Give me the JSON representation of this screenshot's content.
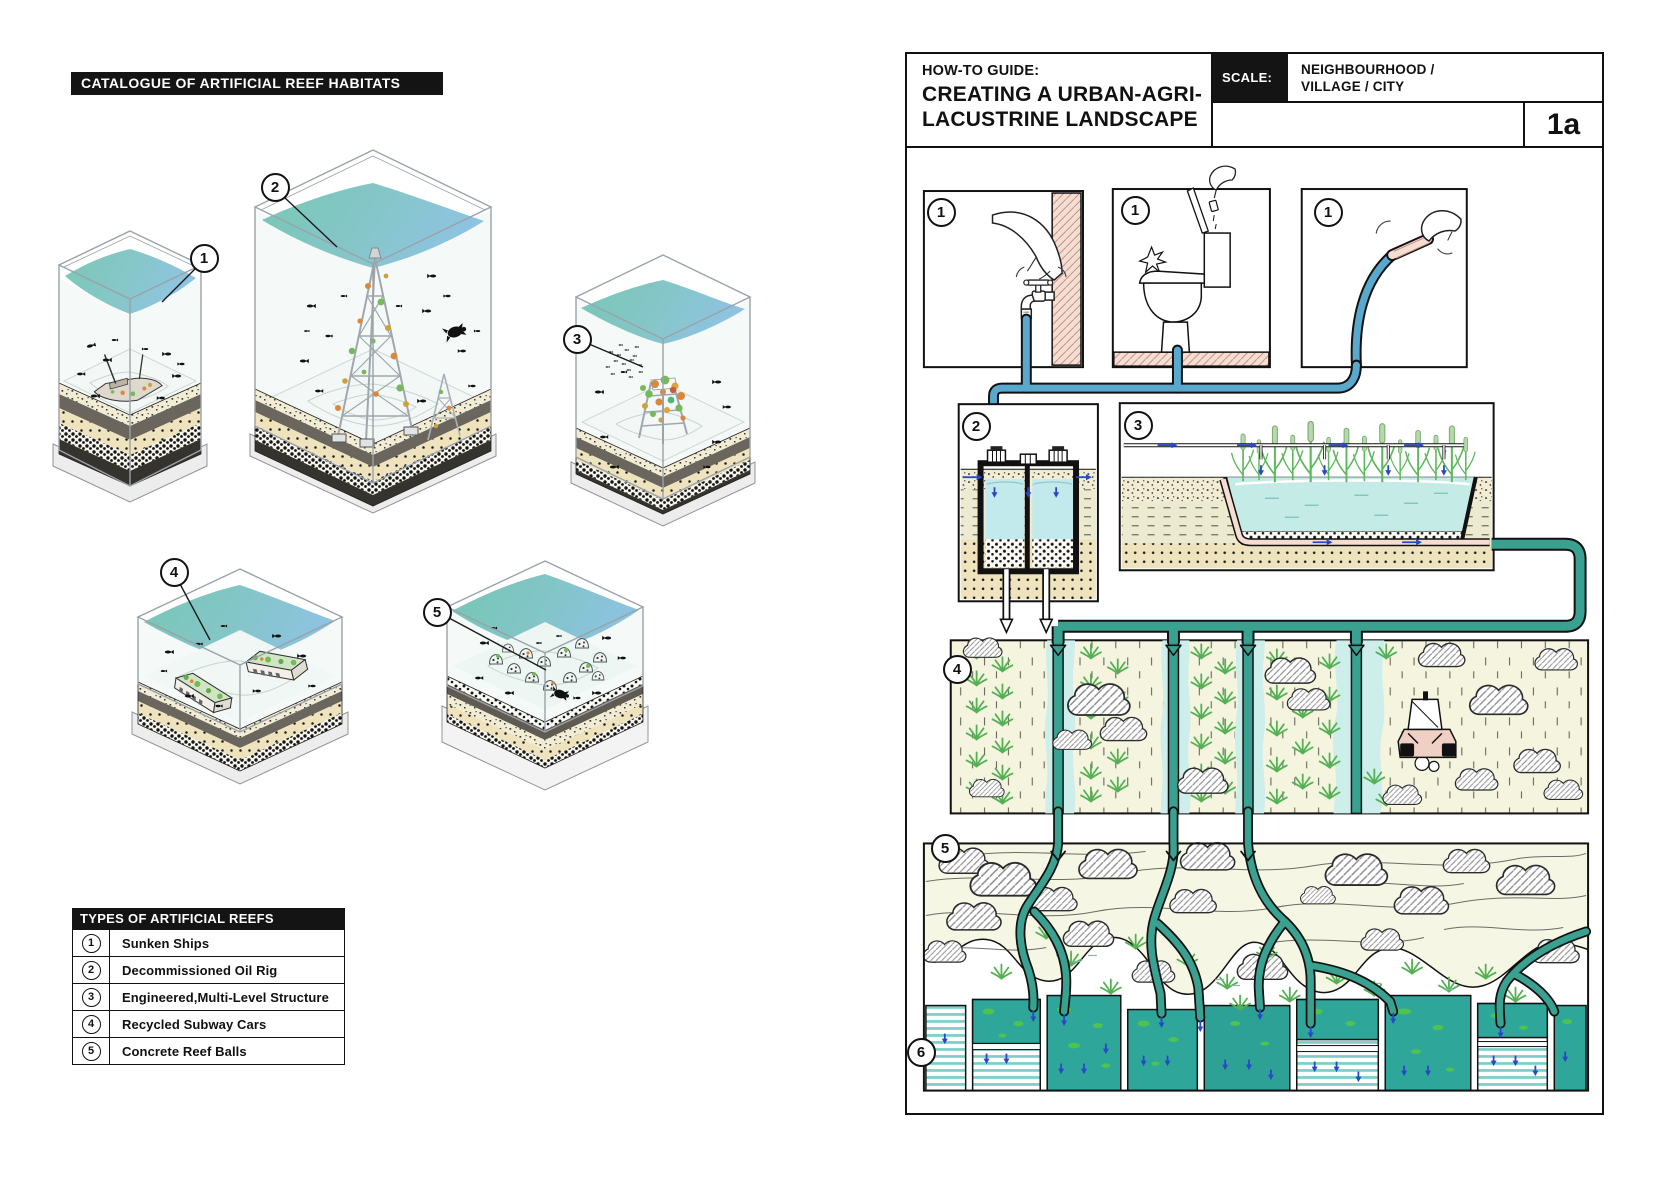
{
  "left_panel": {
    "title": "CATALOGUE OF ARTIFICIAL REEF HABITATS",
    "case_labels": [
      "1",
      "2",
      "3",
      "4",
      "5"
    ],
    "legend": {
      "title": "TYPES OF ARTIFICIAL REEFS",
      "rows": [
        {
          "num": "1",
          "label": "Sunken Ships"
        },
        {
          "num": "2",
          "label": "Decommissioned Oil Rig"
        },
        {
          "num": "3",
          "label": "Engineered,Multi-Level Structure"
        },
        {
          "num": "4",
          "label": "Recycled Subway Cars"
        },
        {
          "num": "5",
          "label": "Concrete Reef Balls"
        }
      ]
    }
  },
  "right_panel": {
    "header": {
      "kicker": "HOW-TO GUIDE:",
      "title_line1": "CREATING A URBAN-AGRI-",
      "title_line2": "LACUSTRINE LANDSCAPE",
      "scale_label": "SCALE:",
      "scale_value_line1": "NEIGHBOURHOOD /",
      "scale_value_line2": "VILLAGE / CITY",
      "sheet_ref": "1a"
    },
    "step_labels": {
      "tap": "1",
      "toilet": "1",
      "hose": "1",
      "tanks": "2",
      "wetland": "3",
      "fields": "4",
      "landscape": "5",
      "basins": "6"
    }
  },
  "colors": {
    "accent_black": "#141414",
    "pipe_blue": "#58a9cd",
    "channel_teal": "#3aa090",
    "pond_cyan": "#c5ebe7",
    "basin_teal": "#2fa69a",
    "algae_green": "#4ec44f",
    "arrow_blue": "#2947c9",
    "field_cream": "#f4f4df",
    "landscape_cream": "#f6f6e4",
    "pink_hatch": "#f8ded2",
    "surface_teal": "#6ec3af",
    "surface_blue": "#86bfdf"
  }
}
